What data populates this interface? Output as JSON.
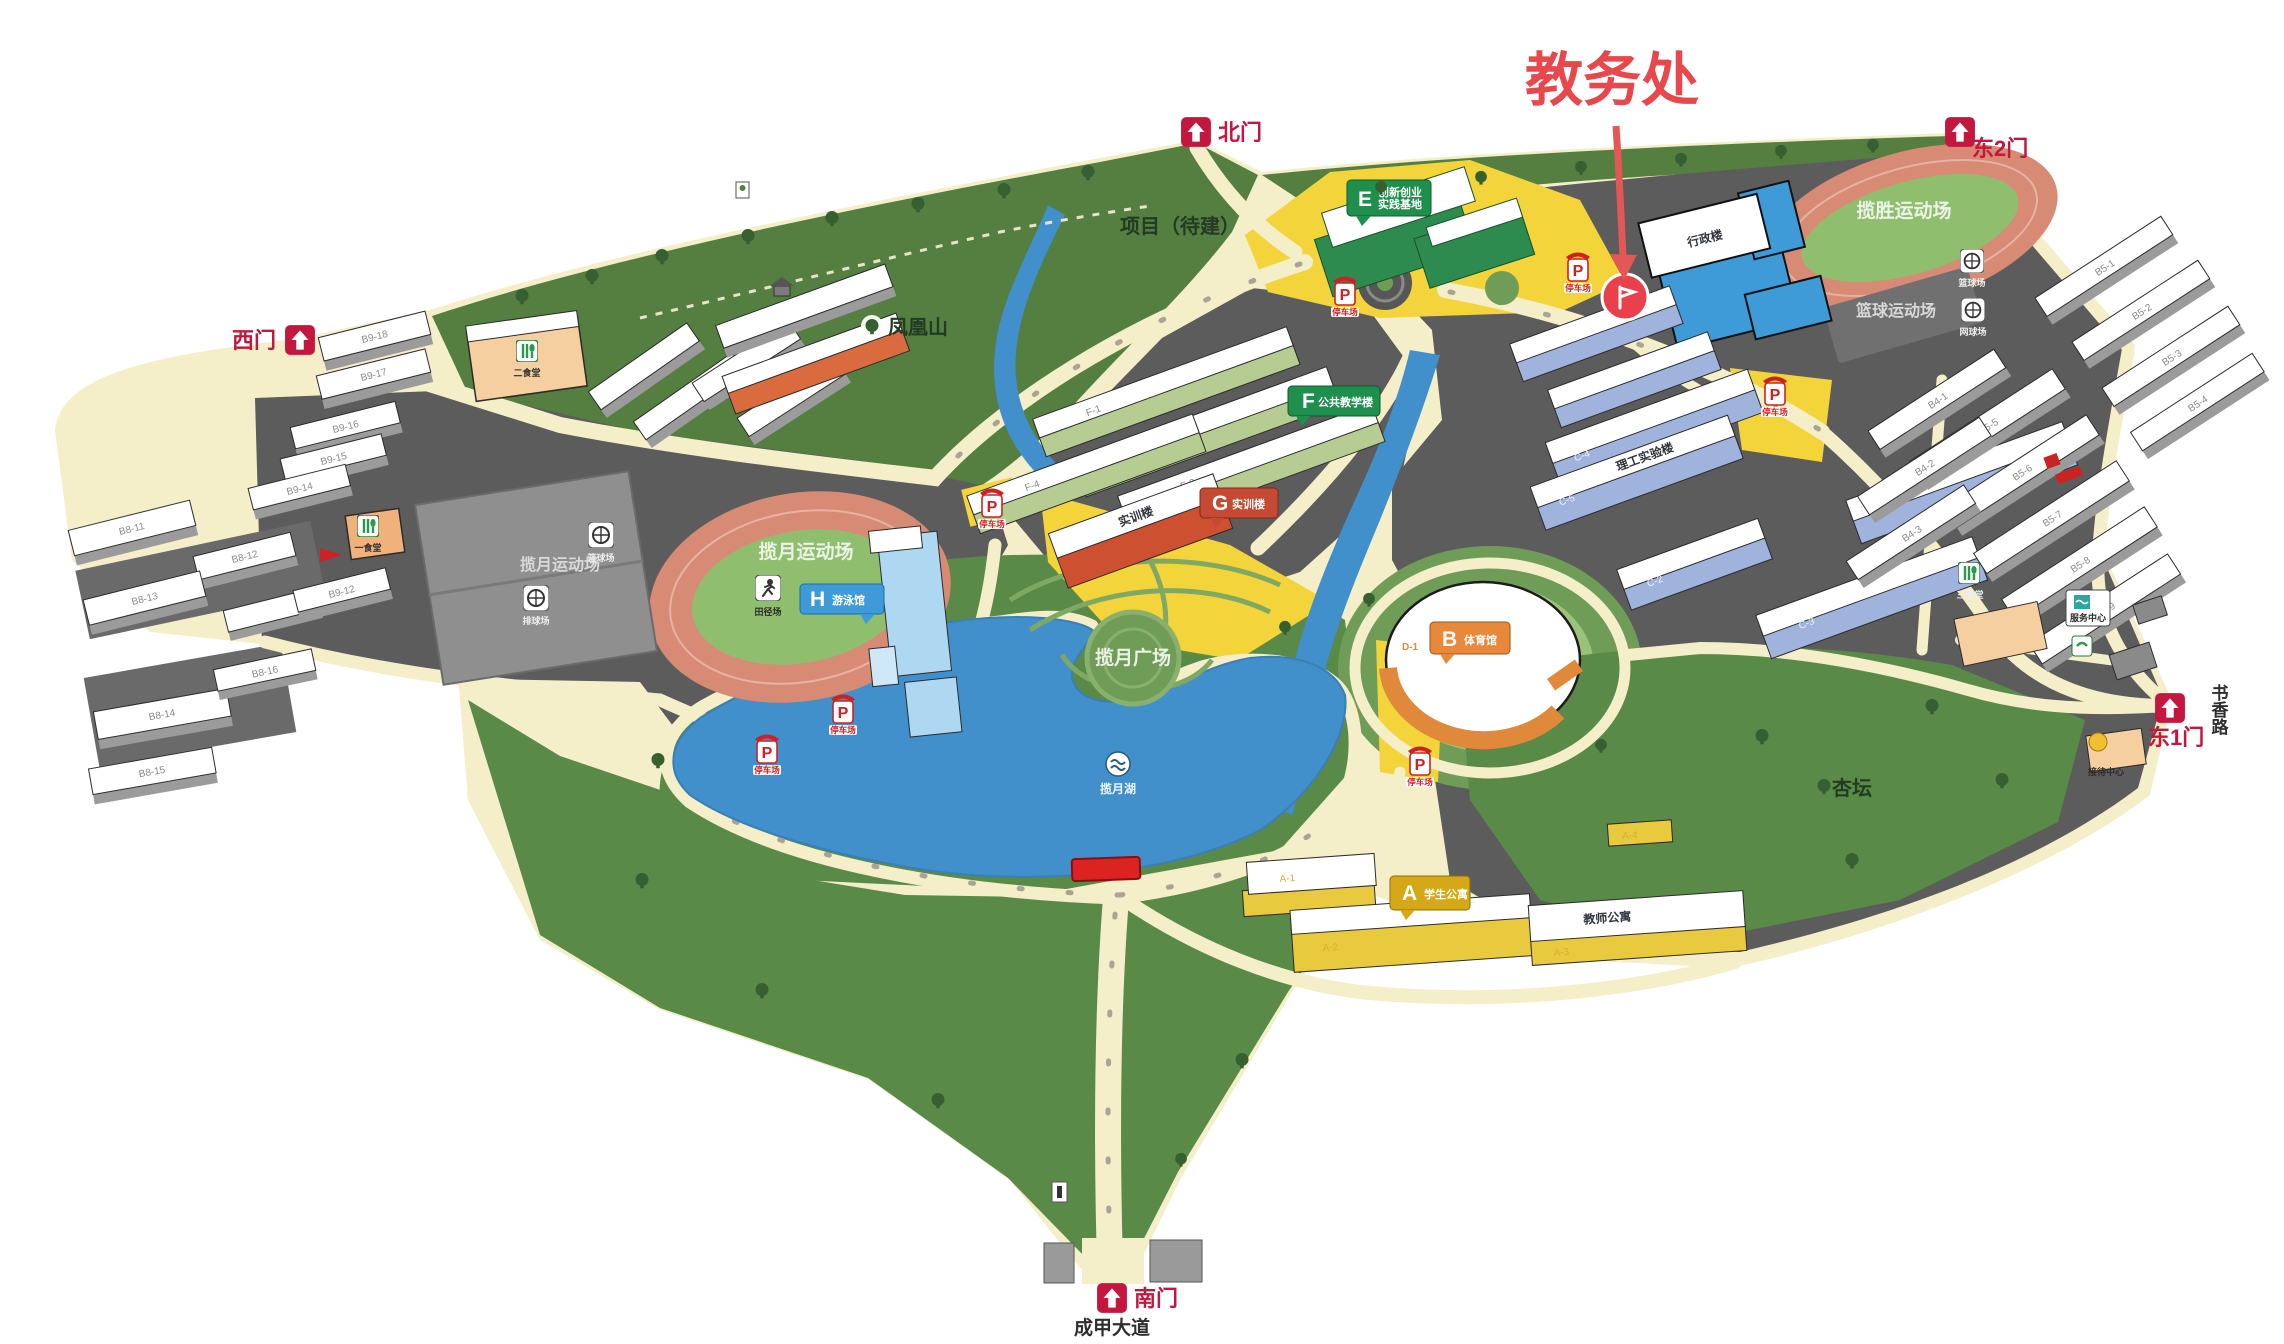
{
  "annotation": {
    "text": "教务处"
  },
  "gates": {
    "north": "北门",
    "east2": "东2门",
    "east1": "东1门",
    "west": "西门",
    "south": "南门"
  },
  "roads": {
    "south_avenue": "成甲大道",
    "east_road": "书香路"
  },
  "areas": {
    "hill": "凤凰山",
    "project": "项目（待建）",
    "plaza": "揽月广场",
    "lake": "揽月湖",
    "west_field": "揽月运动场",
    "west_courts": "揽月运动场",
    "ne_field": "揽胜运动场",
    "ne_courts": "篮球运动场",
    "apricot_grove": "杏坛"
  },
  "sport_labels": {
    "basketball": "篮球场",
    "volleyball": "排球场",
    "tennis": "网球场",
    "track": "田径场"
  },
  "markers": {
    "a": {
      "letter": "A",
      "label": "学生公寓"
    },
    "b": {
      "letter": "B",
      "label": "体育馆"
    },
    "e": {
      "letter": "E",
      "line1": "创新创业",
      "line2": "实践基地"
    },
    "f": {
      "letter": "F",
      "label": "公共教学楼"
    },
    "g": {
      "letter": "G",
      "label": "实训楼"
    },
    "h": {
      "letter": "H",
      "label": "游泳馆"
    },
    "p": {
      "letter": "P",
      "label": "停车场"
    }
  },
  "buildings": {
    "admin_roof": "行政楼",
    "g_roof": "实训楼",
    "c_roof": "理工实验楼",
    "a_roof": "教师公寓",
    "canteen_west": "一食堂",
    "canteen_center": "二食堂",
    "canteen_east": "三食堂",
    "service_center": "服务中心",
    "reception": "接待中心",
    "codes": {
      "a1": "A-1",
      "a2": "A-2",
      "a3": "A-3",
      "a4": "A-4",
      "c2": "C-2",
      "c3": "C-3",
      "c4": "C-4",
      "c5": "C-5",
      "d1": "D-1",
      "f1": "F-1",
      "f2": "F-2",
      "f3": "F-3",
      "f4": "F-4",
      "b918": "B9-18",
      "b917": "B9-17",
      "b916": "B9-16",
      "b915": "B9-15",
      "b914": "B9-14",
      "b912": "B9-12",
      "b81": "B8-11",
      "b82": "B8-12",
      "b83": "B8-13",
      "b84": "B8-14",
      "b85": "B8-15",
      "b86": "B8-16",
      "b51": "B5-1",
      "b52": "B5-2",
      "b53": "B5-3",
      "b54": "B5-4",
      "b55": "B5-5",
      "b56": "B5-6",
      "b57": "B5-7",
      "b58": "B5-8",
      "b59": "B5-9",
      "b41": "B4-1",
      "b42": "B4-2",
      "b43": "B4-3"
    }
  },
  "colors": {
    "annotation_red": "#e8474b",
    "gate_red": "#c4173f",
    "hill_green": "#547f41",
    "lawn_green": "#5a8a48",
    "road_cream": "#f4eec9",
    "zone_grey": "#5c5c5c",
    "lake_blue": "#4190cb",
    "track_salmon": "#d78b74",
    "infield_green": "#8fbf6e",
    "admin_blue": "#3f9bd8",
    "marker_yellow": "#f3d43a"
  }
}
